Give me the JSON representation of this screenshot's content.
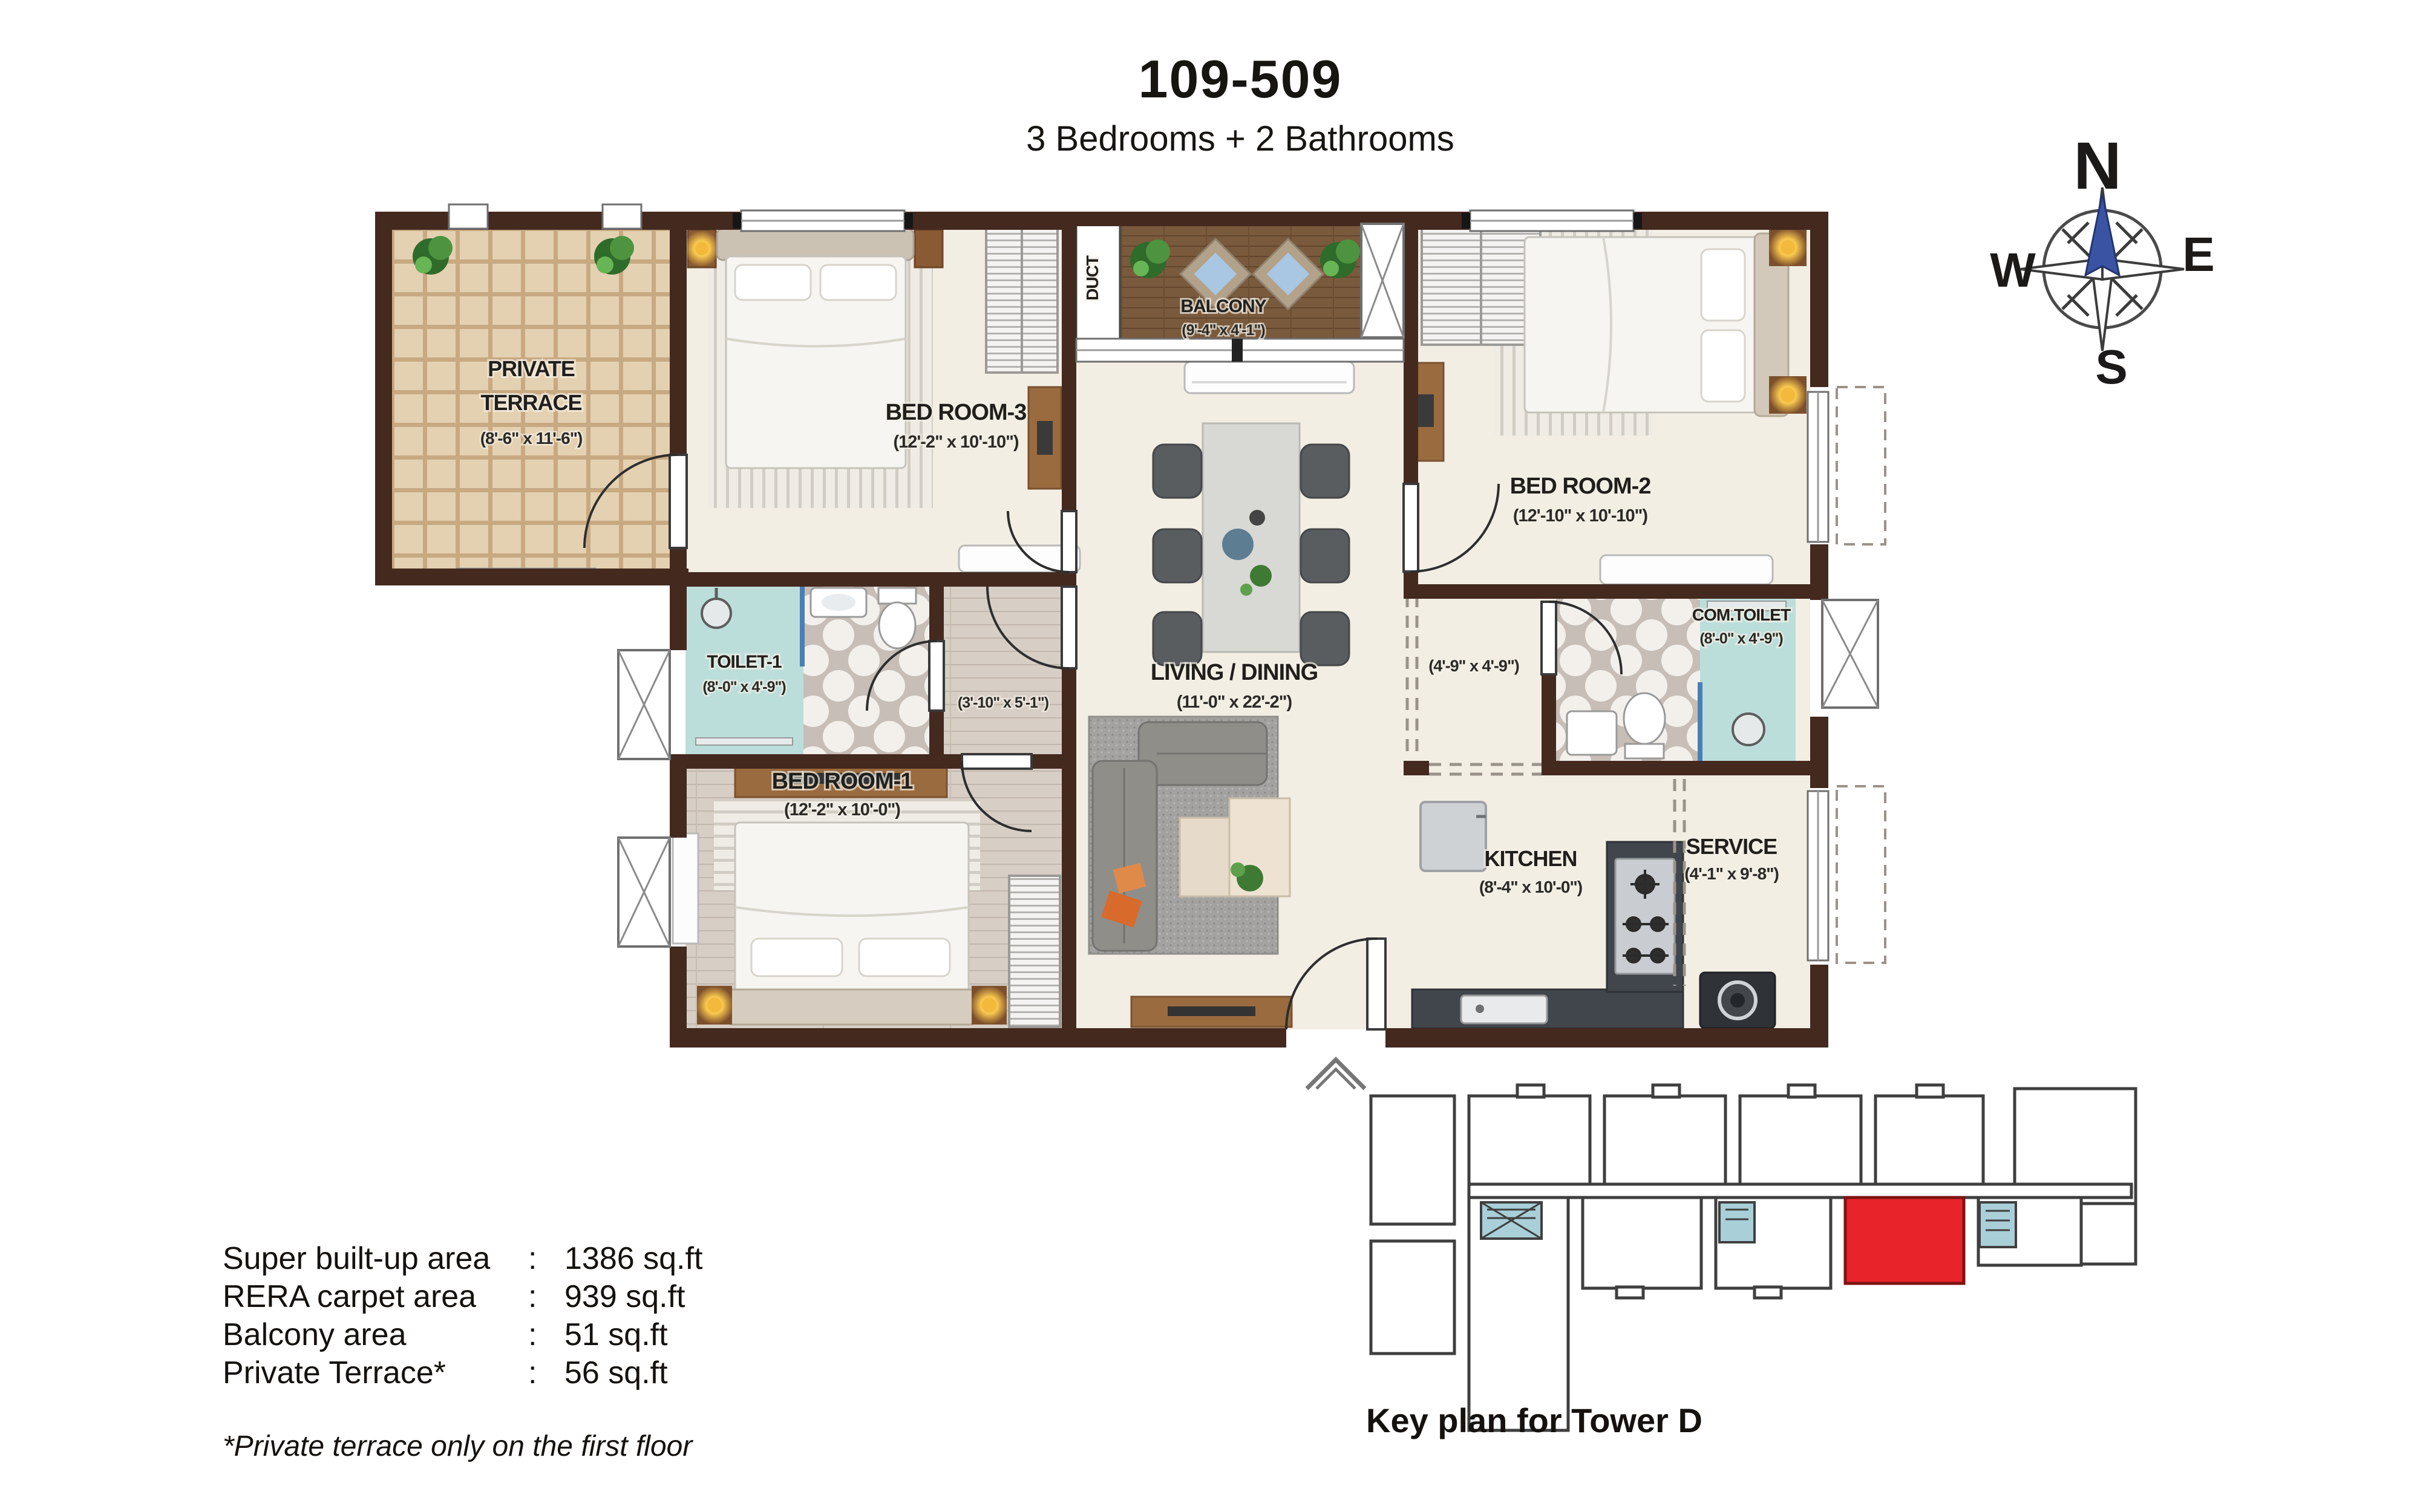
{
  "header": {
    "title": "109-509",
    "subtitle": "3 Bedrooms + 2 Bathrooms"
  },
  "compass": {
    "n": "N",
    "e": "E",
    "s": "S",
    "w": "W"
  },
  "rooms": {
    "private_terrace": {
      "line1": "PRIVATE",
      "line2": "TERRACE",
      "dims": "(8'-6\" x 11'-6\")"
    },
    "bedroom3": {
      "name": "BED ROOM-3",
      "dims": "(12'-2\" x 10'-10\")"
    },
    "balcony": {
      "name": "BALCONY",
      "dims": "(9'-4\" x 4'-1\")"
    },
    "duct": {
      "name": "DUCT"
    },
    "bedroom2": {
      "name": "BED ROOM-2",
      "dims": "(12'-10\" x 10'-10\")"
    },
    "toilet1": {
      "name": "TOILET-1",
      "dims": "(8'-0\" x 4'-9\")"
    },
    "corridor": {
      "dims": "(3'-10\" x 5'-1\")"
    },
    "living_dining": {
      "name": "LIVING / DINING",
      "dims": "(11'-0\" x 22'-2\")"
    },
    "passage": {
      "dims": "(4'-9\" x 4'-9\")"
    },
    "com_toilet": {
      "name": "COM.TOILET",
      "dims": "(8'-0\" x 4'-9\")"
    },
    "bedroom1": {
      "name": "BED ROOM-1",
      "dims": "(12'-2\" x 10'-0\")"
    },
    "kitchen": {
      "name": "KITCHEN",
      "dims": "(8'-4\" x 10'-0\")"
    },
    "service": {
      "name": "SERVICE",
      "dims": "(4'-1\" x 9'-8\")"
    }
  },
  "areas": {
    "colon": ":",
    "rows": [
      {
        "label": "Super built-up area",
        "value": "1386 sq.ft"
      },
      {
        "label": "RERA carpet area",
        "value": "939 sq.ft"
      },
      {
        "label": "Balcony area",
        "value": "51 sq.ft"
      },
      {
        "label": "Private Terrace*",
        "value": "56 sq.ft"
      }
    ],
    "footnote": "*Private terrace only on the first floor"
  },
  "keyplan": {
    "caption": "Key plan for Tower D"
  },
  "colors": {
    "wall": "#44291f",
    "highlight_red": "#e8242a",
    "toilet_cyan": "#bcdedb",
    "north_red": "#ed1c24",
    "needle_blue": "#3b53a3"
  }
}
